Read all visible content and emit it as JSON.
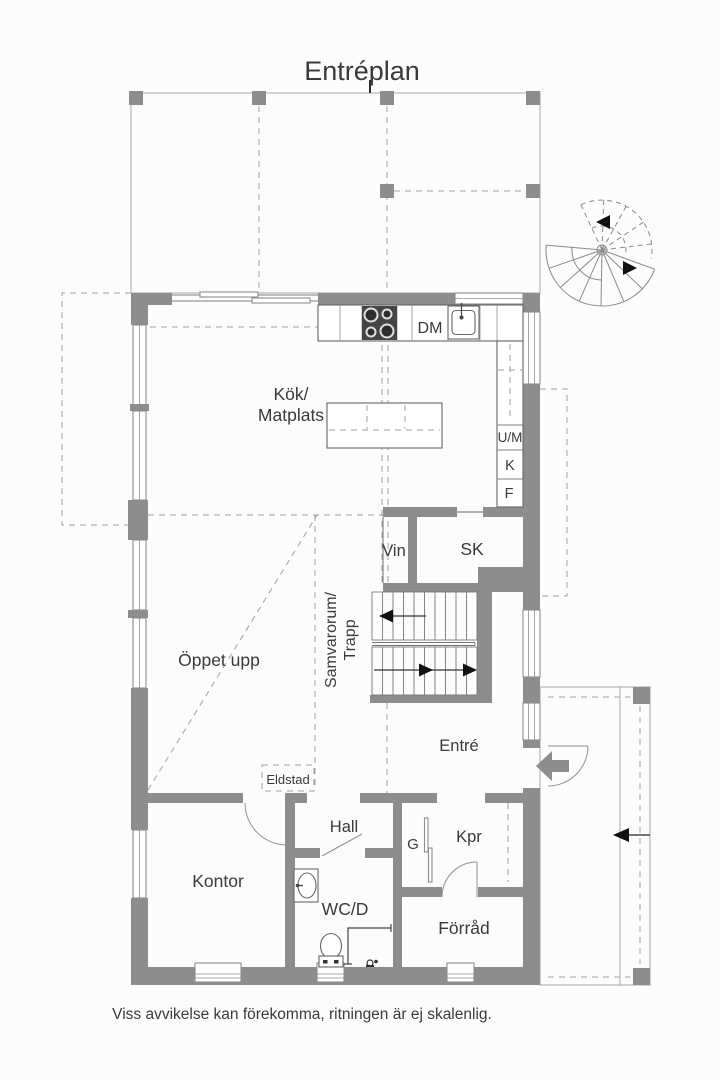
{
  "page": {
    "title": "Entréplan",
    "disclaimer": "Viss avvikelse kan förekomma, ritningen är ej skalenlig."
  },
  "rooms": {
    "kitchen_line1": "Kök/",
    "kitchen_line2": "Matplats",
    "open_above": "Öppet upp",
    "social_line1": "Samvarorum/",
    "social_line2": "Trapp",
    "entrance": "Entré",
    "hall": "Hall",
    "office": "Kontor",
    "wc": "WC/D",
    "storage": "Förråd",
    "cloakroom": "Kpr",
    "wardrobe": "G",
    "wine": "Vin",
    "closet": "SK",
    "fireplace": "Eldstad"
  },
  "appliances": {
    "dishwasher": "DM",
    "oven_micro": "U/M",
    "fridge": "K",
    "freezer": "F"
  },
  "colors": {
    "wall_gray": "#8d8d8d",
    "line_gray": "#7d7d7d",
    "dash_gray": "#9f9f9f",
    "text": "#3a3a3a",
    "background": "#fcfcfc"
  }
}
